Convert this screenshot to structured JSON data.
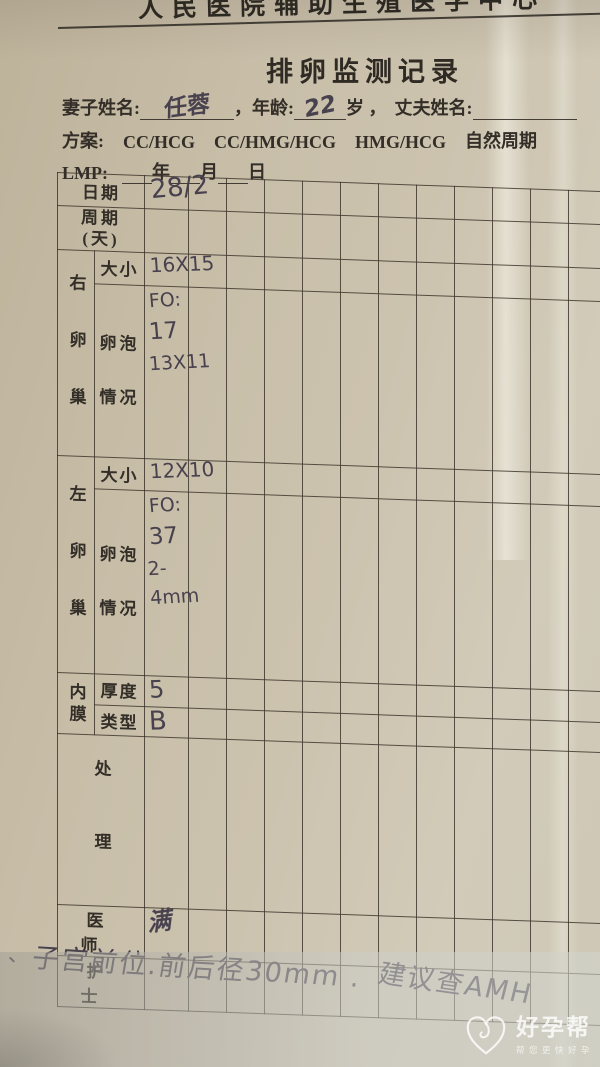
{
  "header": {
    "clipped_text": "人民医院辅助生殖医学中心",
    "title": "排卵监测记录"
  },
  "patient": {
    "wife_label": "妻子姓名:",
    "wife_name": "任蓉",
    "age_label": "，年龄:",
    "age_value": "22",
    "age_unit": "岁 ，",
    "husband_label": "丈夫姓名:",
    "plan_label": "方案:",
    "plan_options": [
      "CC/HCG",
      "CC/HMG/HCG",
      "HMG/HCG",
      "自然周期"
    ],
    "lmp_label": "LMP:",
    "lmp_year": "年",
    "lmp_month": "月",
    "lmp_day": "日"
  },
  "table": {
    "date_label": "日期",
    "date_value": "28/2",
    "cycle_label": [
      "周期",
      "(天)"
    ],
    "right_ovary_label": "右卵巢",
    "left_ovary_label": "左卵巢",
    "size_label": "大小",
    "follicle_label": [
      "卵泡",
      "情况"
    ],
    "right_size_value": "16X15",
    "right_follicle_lines": [
      "FO:",
      "17",
      "13X11"
    ],
    "left_size_value": "12X10",
    "left_follicle_lines": [
      "FO:",
      "37",
      "2-4mm"
    ],
    "endometrium_label": "内膜",
    "thickness_label": "厚度",
    "thickness_value": "5",
    "type_label": "类型",
    "type_value": "B",
    "treatment_label": "处理",
    "doctor_label": "医师",
    "doctor_signature": "满",
    "nurse_label": "护士"
  },
  "footnote": {
    "tick": "、",
    "part1": "子宫前位.前后径30mm .",
    "part2": "建议查AMH"
  },
  "watermark": {
    "brand": "好孕帮",
    "tagline": "帮您更快好孕"
  },
  "colors": {
    "paper": "#c9c0ab",
    "ink_print": "#35302a",
    "ink_pen": "#48414e",
    "watermark": "rgba(255,255,255,0.8)"
  }
}
